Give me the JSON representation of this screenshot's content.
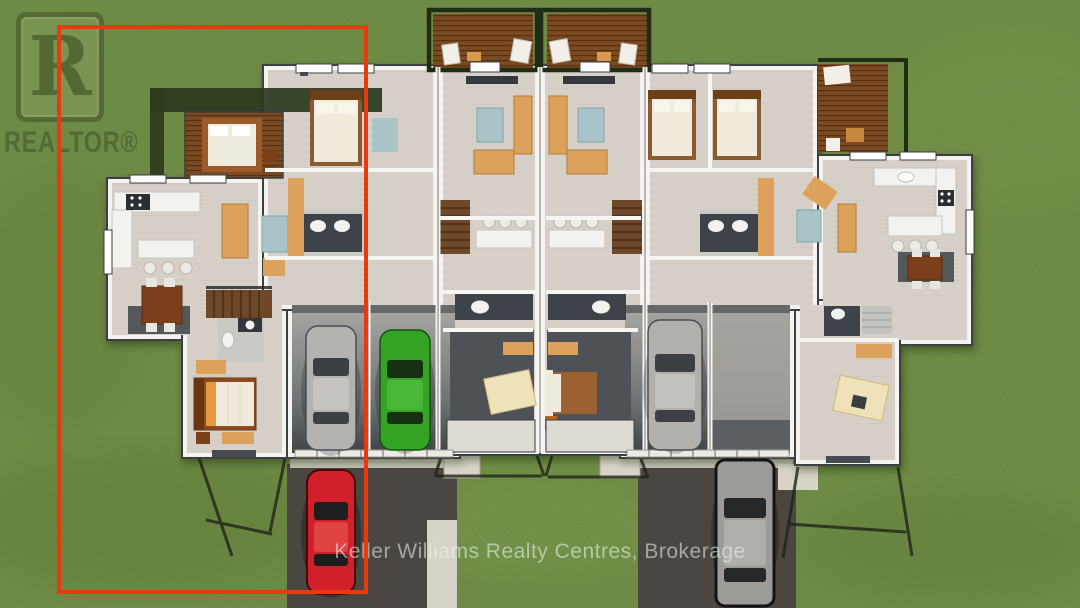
{
  "watermark": {
    "logo_letter": "R",
    "logo_text": "REALTOR®"
  },
  "footer": {
    "brokerage_text": "Keller Williams Realty Centres, Brokerage"
  },
  "highlight": {
    "label": "highlighted-left-unit",
    "color": "#e8390f"
  },
  "theme": {
    "grass": "#6d8c41",
    "driveway": "#4b4442",
    "deck_wood": "#7a4a22",
    "walkway": "#d7d3c8",
    "floor": "#d6d0c8",
    "wall": "#f4f3f0",
    "wall_edge": "#3a3f42",
    "pergola": "#1f2d15"
  },
  "cars": {
    "garage_gray_left": {
      "label": "gray car in left garage",
      "color": "#b5b3af"
    },
    "garage_green": {
      "label": "green car in garage",
      "color": "#33a423"
    },
    "garage_gray_right": {
      "label": "gray car in right garage",
      "color": "#b2b0ac"
    },
    "driveway_red": {
      "label": "red car on left driveway",
      "color": "#d2202a"
    },
    "driveway_suv": {
      "label": "gray suv on right driveway",
      "color": "#9d9b97"
    }
  }
}
